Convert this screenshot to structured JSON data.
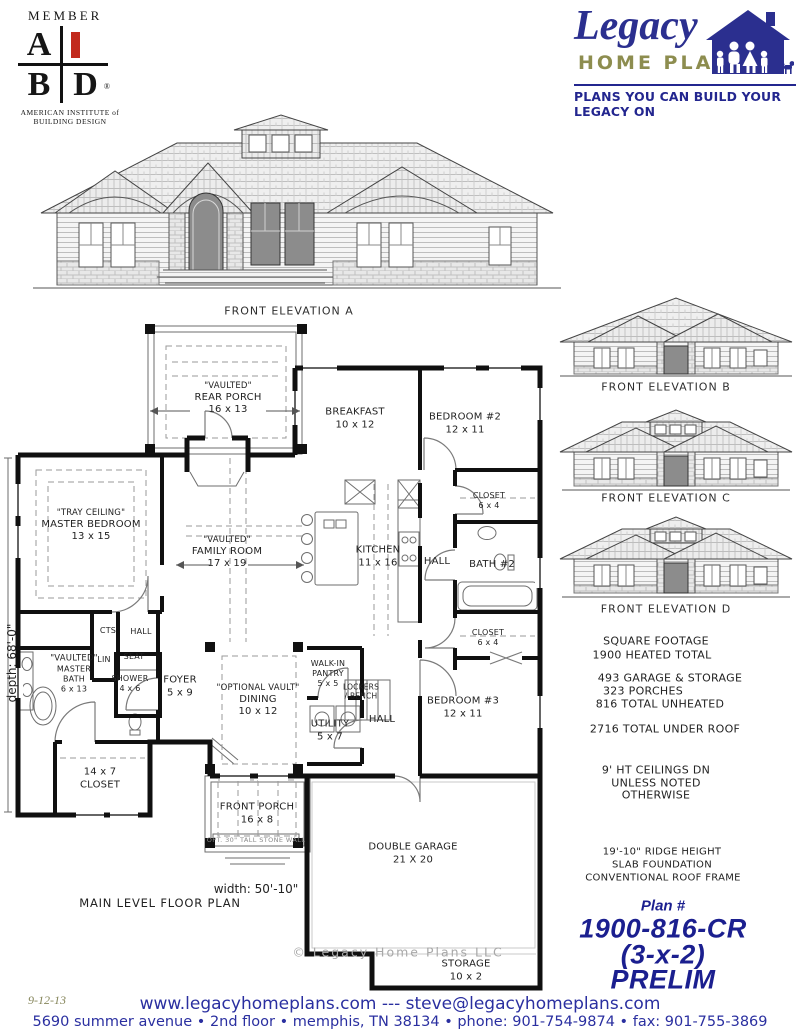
{
  "colors": {
    "navy": "#23268f",
    "olive": "#8d8d4f",
    "red": "#c22a1d",
    "ink": "#1a1a1a"
  },
  "member_badge": {
    "member": "MEMBER",
    "a": "A",
    "b": "B",
    "d": "D",
    "reg": "®",
    "org_line1": "AMERICAN INSTITUTE of",
    "org_line2": "BUILDING DESIGN"
  },
  "brand": {
    "name": "Legacy",
    "word": "HOME PLANS",
    "tagline": "PLANS YOU CAN BUILD YOUR LEGACY ON"
  },
  "elevations": {
    "a": "FRONT ELEVATION A",
    "b": "FRONT ELEVATION B",
    "c": "FRONT ELEVATION C",
    "d": "FRONT ELEVATION D"
  },
  "plan": {
    "title": "MAIN LEVEL FLOOR PLAN",
    "width_label": "width: 50'-10\"",
    "depth_label": "depth: 68'-0\"",
    "copyright": "© Legacy Home Plans LLC",
    "stem_wall_note": "OPT. 30\" TALL STONE WALL",
    "rooms": [
      {
        "id": "rear-porch",
        "lines": [
          "\"VAULTED\"",
          "REAR PORCH",
          "16 x 13"
        ]
      },
      {
        "id": "breakfast",
        "lines": [
          "BREAKFAST",
          "10 x 12"
        ]
      },
      {
        "id": "bedroom-2",
        "lines": [
          "BEDROOM #2",
          "12 x 11"
        ]
      },
      {
        "id": "closet-bed2",
        "lines": [
          "CLOSET",
          "6 x 4"
        ]
      },
      {
        "id": "master-bedroom",
        "lines": [
          "\"TRAY CEILING\"",
          "MASTER BEDROOM",
          "13 x 15"
        ]
      },
      {
        "id": "family-room",
        "lines": [
          "\"VAULTED\"",
          "FAMILY ROOM",
          "17 x 19"
        ]
      },
      {
        "id": "kitchen",
        "lines": [
          "KITCHEN",
          "11 x 16"
        ]
      },
      {
        "id": "hall-upper",
        "lines": [
          "HALL"
        ]
      },
      {
        "id": "bath-2",
        "lines": [
          "BATH #2"
        ]
      },
      {
        "id": "closet-bed3",
        "lines": [
          "CLOSET",
          "6 x 4"
        ]
      },
      {
        "id": "cts",
        "lines": [
          "CTS"
        ]
      },
      {
        "id": "hall-master",
        "lines": [
          "HALL"
        ]
      },
      {
        "id": "linen",
        "lines": [
          "LIN"
        ]
      },
      {
        "id": "seat",
        "lines": [
          "SEAT"
        ]
      },
      {
        "id": "master-bath",
        "lines": [
          "\"VAULTED\"",
          "MASTER",
          "BATH",
          "6 x 13"
        ]
      },
      {
        "id": "shower",
        "lines": [
          "SHOWER",
          "4 x 6"
        ]
      },
      {
        "id": "foyer",
        "lines": [
          "FOYER",
          "5 x 9"
        ]
      },
      {
        "id": "dining",
        "lines": [
          "\"OPTIONAL VAULT\"",
          "DINING",
          "10 x 12"
        ]
      },
      {
        "id": "pantry",
        "lines": [
          "WALK-IN",
          "PANTRY",
          "5 x 5"
        ]
      },
      {
        "id": "lockers",
        "lines": [
          "LOCKERS",
          "/ BENCH"
        ]
      },
      {
        "id": "utility",
        "lines": [
          "UTILITY",
          "5 x 7"
        ]
      },
      {
        "id": "hall-rear",
        "lines": [
          "HALL"
        ]
      },
      {
        "id": "bedroom-3",
        "lines": [
          "BEDROOM #3",
          "12 x 11"
        ]
      },
      {
        "id": "master-closet",
        "lines": [
          "14 x 7",
          "CLOSET"
        ]
      },
      {
        "id": "front-porch",
        "lines": [
          "FRONT PORCH",
          "16 x 8"
        ]
      },
      {
        "id": "double-garage",
        "lines": [
          "DOUBLE GARAGE",
          "21 X 20"
        ]
      },
      {
        "id": "storage",
        "lines": [
          "STORAGE",
          "10 x 2"
        ]
      }
    ]
  },
  "square_footage": {
    "title": "SQUARE FOOTAGE",
    "heated": "1900  HEATED TOTAL",
    "garage_storage": "493  GARAGE & STORAGE",
    "porches": "323  PORCHES",
    "unheated": "816  TOTAL UNHEATED",
    "under_roof": "2716  TOTAL UNDER ROOF"
  },
  "ceiling_note": {
    "l1": "9' HT CEILINGS DN",
    "l2": "UNLESS NOTED",
    "l3": "OTHERWISE"
  },
  "construction": {
    "ridge": "19'-10\" RIDGE HEIGHT",
    "foundation": "SLAB FOUNDATION",
    "roof": "CONVENTIONAL ROOF FRAME"
  },
  "plan_id": {
    "label": "Plan #",
    "number": "1900-816-CR",
    "config": "(3-x-2)",
    "status": "PRELIM"
  },
  "footer": {
    "date": "9-12-13",
    "contact": "www.legacyhomeplans.com --- steve@legacyhomeplans.com",
    "address": "5690 summer avenue  •  2nd floor  •  memphis, TN  38134  •  phone: 901-754-9874  •  fax: 901-755-3869"
  }
}
